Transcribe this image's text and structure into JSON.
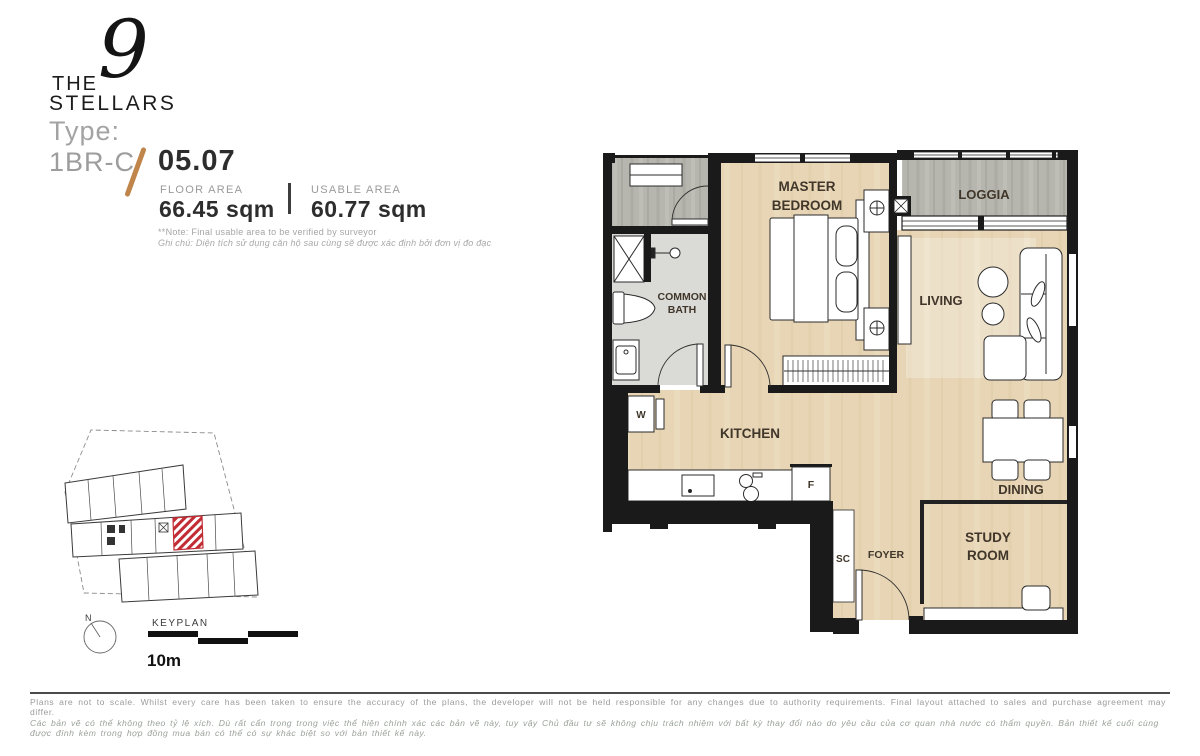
{
  "header": {
    "brand_the": "THE",
    "brand_number": "9",
    "brand_name": "STELLARS",
    "type_label": "Type:",
    "unit_type": "1BR-C",
    "unit_number": "05.07",
    "floor_area_label": "FLOOR AREA",
    "floor_area_value": "66.45 sqm",
    "usable_area_label": "USABLE AREA",
    "usable_area_value": "60.77 sqm",
    "note_en": "**Note: Final usable area to be verified by surveyor",
    "note_vi": "Ghi chú: Diện tích sử dụng căn hộ sau cùng sẽ được xác định bởi đơn vị đo đạc",
    "accent_color": "#c0854a"
  },
  "floorplan": {
    "labels": {
      "master_1": "MASTER",
      "master_2": "BEDROOM",
      "loggia": "LOGGIA",
      "living": "LIVING",
      "common_1": "COMMON",
      "common_2": "BATH",
      "kitchen": "KITCHEN",
      "dining": "DINING",
      "study_1": "STUDY",
      "study_2": "ROOM",
      "foyer": "FOYER",
      "washer": "W",
      "fridge": "F",
      "shoe_cabinet": "SC"
    },
    "colors": {
      "wall": "#1a1a1a",
      "wood_floor": "#e7d5b5",
      "balcony_floor": "#b6b6ae",
      "bath_floor": "#dadad6",
      "label_text": "#40362a"
    }
  },
  "keyplan": {
    "label": "KEYPLAN",
    "north_label": "N",
    "scale_label": "10m",
    "highlight_color": "#c22c35"
  },
  "disclaimer": {
    "line_en": "Plans are not to scale. Whilst every care has been taken to ensure the accuracy of the plans, the developer will not be held responsible for any changes due to authority requirements. Final layout attached to sales and purchase agreement may differ.",
    "line_vi": "Các bản vẽ có thể không theo tỷ lệ xích. Dù rất cẩn trọng trong việc thể hiện chính xác các bản vẽ này, tuy vậy Chủ đầu tư sẽ không chịu trách nhiệm với bất kỳ thay đổi nào do yêu cầu của cơ quan nhà nước có thẩm quyền. Bản thiết kế cuối cùng được đính kèm trong hợp đồng mua bán có thể có sự khác biệt so với bản thiết kế này."
  }
}
